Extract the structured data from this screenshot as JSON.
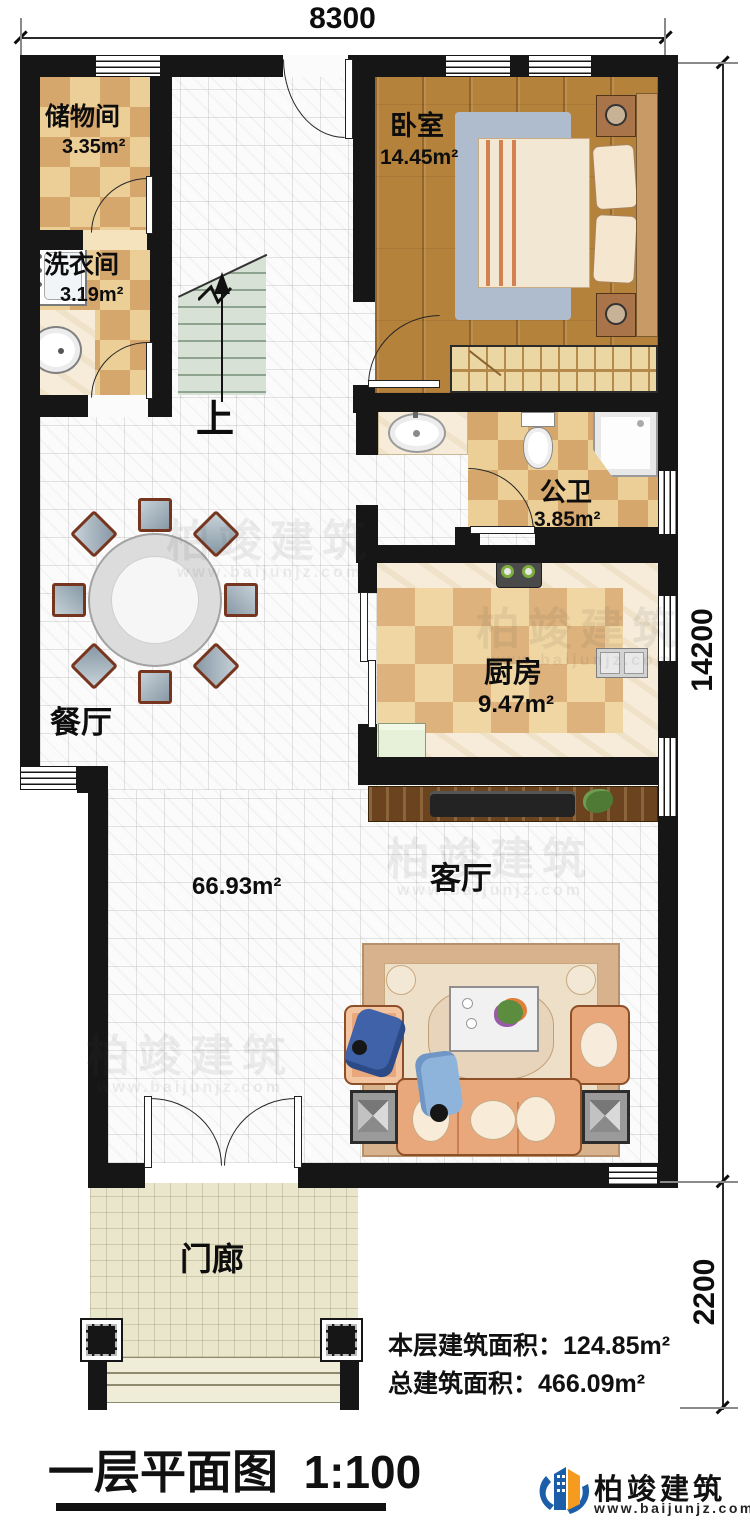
{
  "plan": {
    "dims": {
      "top": "8300",
      "side": "14200",
      "porch_side": "2200"
    },
    "rooms": {
      "storage": {
        "name": "储物间",
        "area": "3.35m²"
      },
      "laundry": {
        "name": "洗衣间",
        "area": "3.19m²"
      },
      "bedroom": {
        "name": "卧室",
        "area": "14.45m²"
      },
      "bathroom": {
        "name": "公卫",
        "area": "3.85m²"
      },
      "kitchen": {
        "name": "厨房",
        "area": "9.47m²"
      },
      "dining": {
        "name": "餐厅"
      },
      "living": {
        "name": "客厅",
        "area": "66.93m²"
      },
      "porch": {
        "name": "门廊"
      },
      "stairs_up": "上"
    }
  },
  "footer": {
    "floor_area_label": "本层建筑面积：",
    "floor_area_value": "124.85m²",
    "total_area_label": "总建筑面积：",
    "total_area_value": "466.09m²",
    "title": "一层平面图",
    "scale": "1:100"
  },
  "brand": {
    "name": "柏竣建筑",
    "url": "www.baijunjz.com"
  },
  "watermark": {
    "text": "柏竣建筑",
    "url": "www.baijunjz.com"
  },
  "colors": {
    "brand_blue": "#1c5fa8",
    "brand_orange": "#f59b20",
    "wall": "#161616"
  }
}
